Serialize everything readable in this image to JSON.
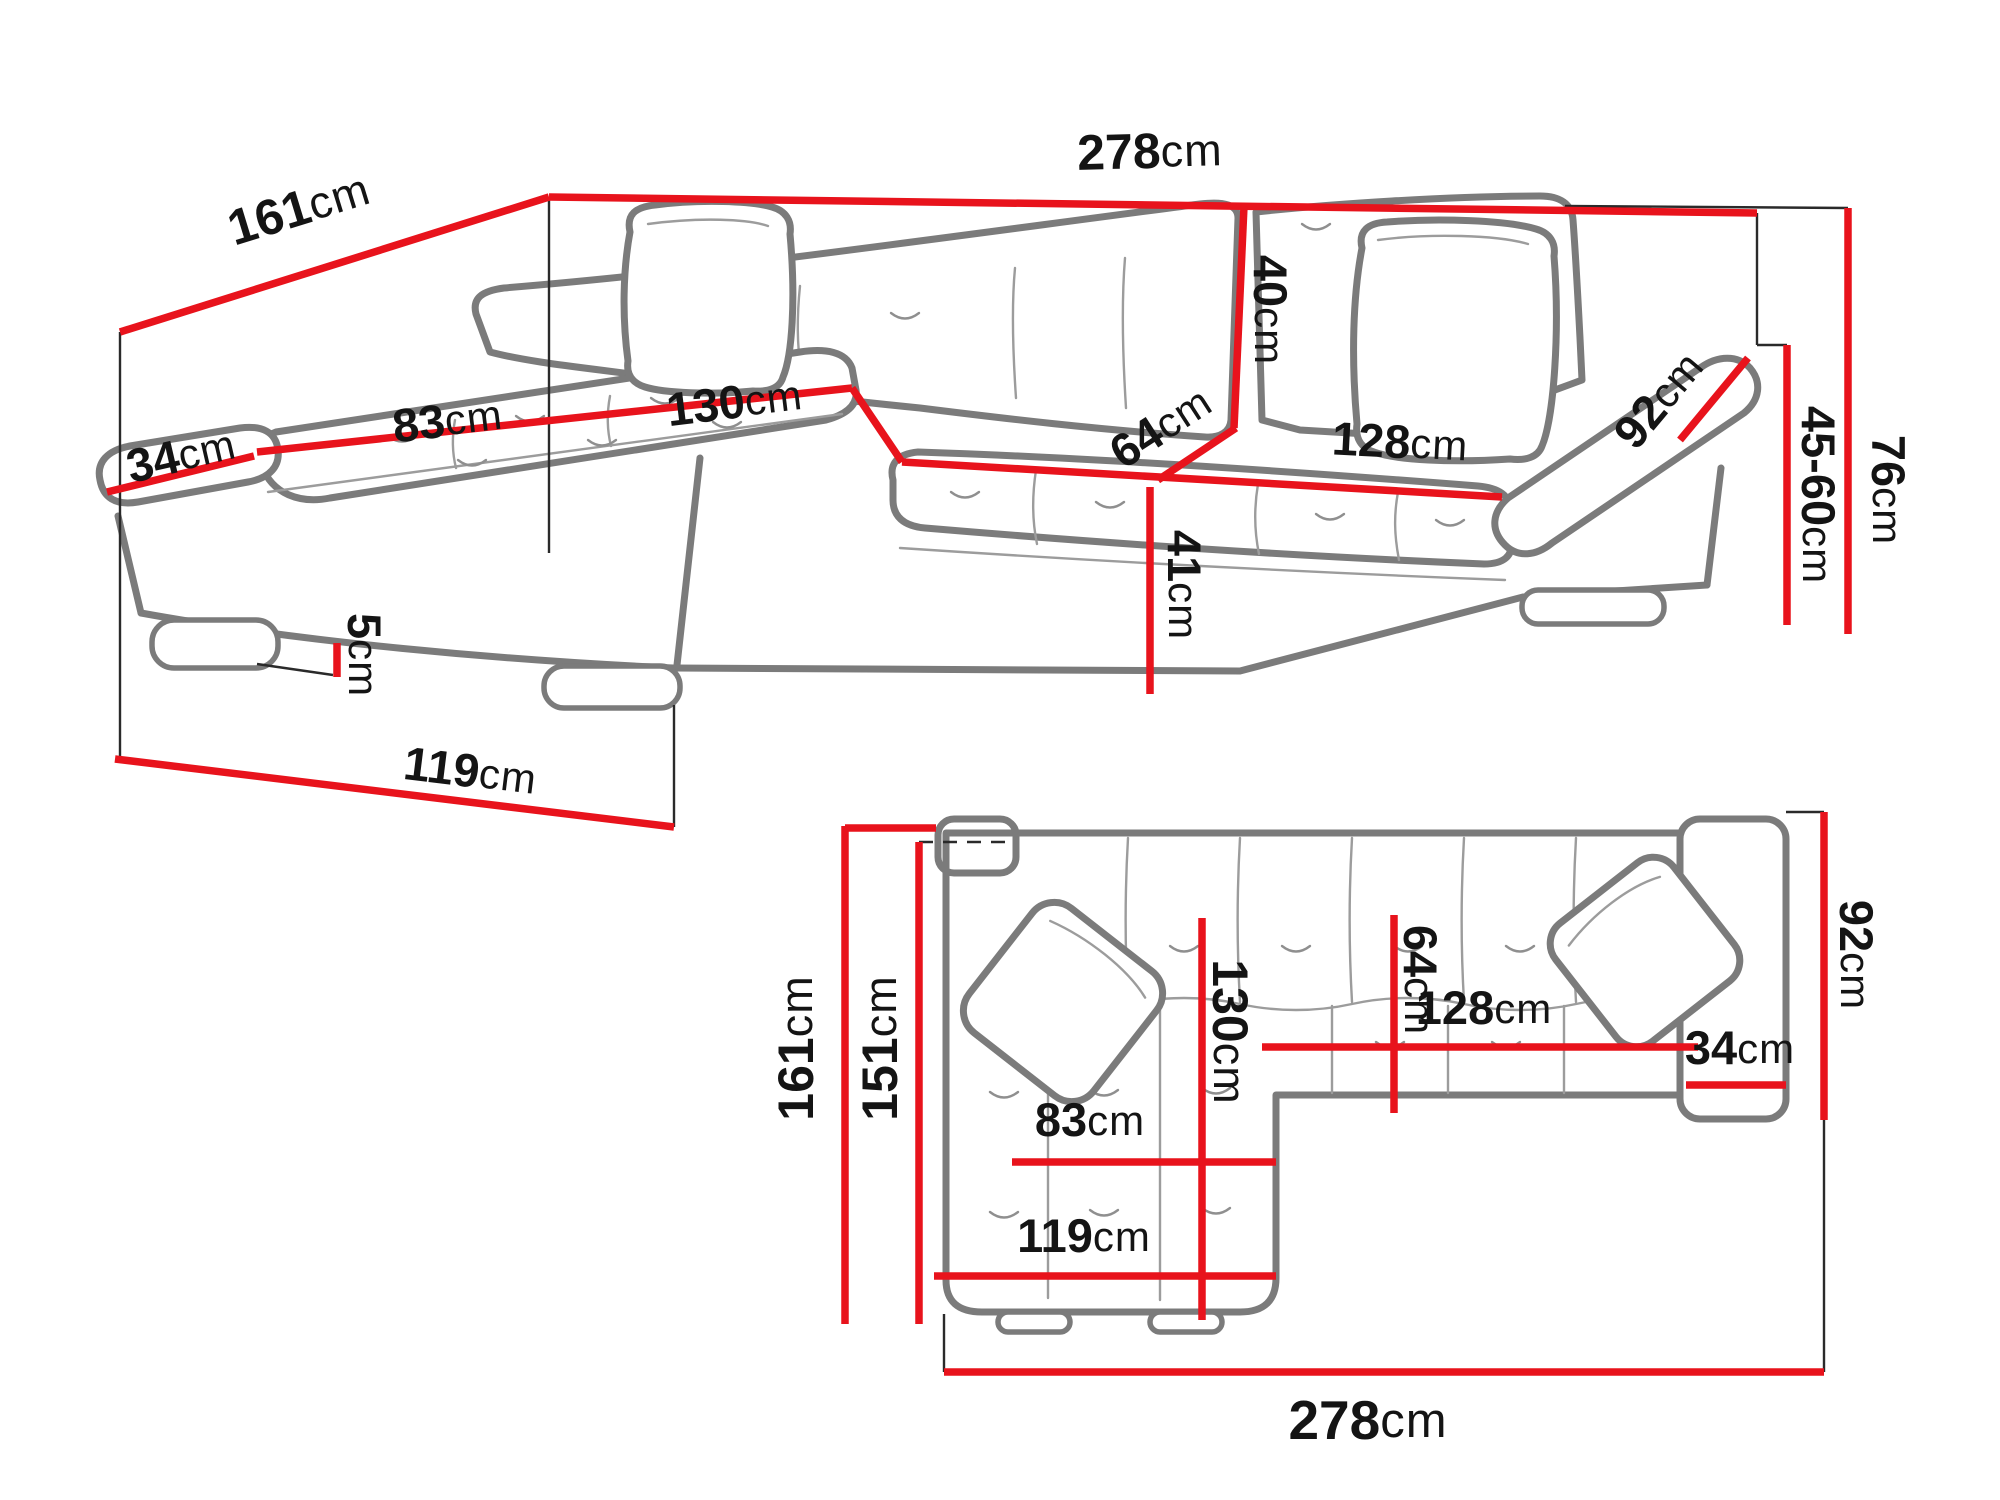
{
  "title": "Corner sofa-bed dimension diagram",
  "colors": {
    "dimension_red": "#e8131c",
    "outline_gray": "#7b7b7b",
    "text_black": "#141414",
    "background": "#ffffff"
  },
  "views": {
    "perspective": {
      "dims": {
        "total_width": {
          "value": "278",
          "unit": "cm"
        },
        "total_depth": {
          "value": "161",
          "unit": "cm"
        },
        "armrest_width": {
          "value": "34",
          "unit": "cm"
        },
        "chaise_seat_width": {
          "value": "83",
          "unit": "cm"
        },
        "chaise_depth": {
          "value": "130",
          "unit": "cm"
        },
        "backrest_height": {
          "value": "40",
          "unit": "cm"
        },
        "seat_depth": {
          "value": "64",
          "unit": "cm"
        },
        "seat_width": {
          "value": "128",
          "unit": "cm"
        },
        "armrest_length": {
          "value": "92",
          "unit": "cm"
        },
        "overall_height": {
          "value": "76",
          "unit": "cm"
        },
        "seat_height_range": {
          "value": "45-60",
          "unit": "cm"
        },
        "front_height": {
          "value": "41",
          "unit": "cm"
        },
        "leg_height": {
          "value": "5",
          "unit": "cm"
        },
        "chaise_front_width": {
          "value": "119",
          "unit": "cm"
        }
      }
    },
    "plan": {
      "dims": {
        "total_depth": {
          "value": "161",
          "unit": "cm"
        },
        "inner_depth": {
          "value": "151",
          "unit": "cm"
        },
        "chaise_depth": {
          "value": "130",
          "unit": "cm"
        },
        "seat_depth": {
          "value": "64",
          "unit": "cm"
        },
        "seat_width": {
          "value": "128",
          "unit": "cm"
        },
        "armrest_width": {
          "value": "34",
          "unit": "cm"
        },
        "armrest_length": {
          "value": "92",
          "unit": "cm"
        },
        "chaise_seat_width": {
          "value": "83",
          "unit": "cm"
        },
        "chaise_width": {
          "value": "119",
          "unit": "cm"
        },
        "total_width": {
          "value": "278",
          "unit": "cm"
        }
      }
    }
  }
}
